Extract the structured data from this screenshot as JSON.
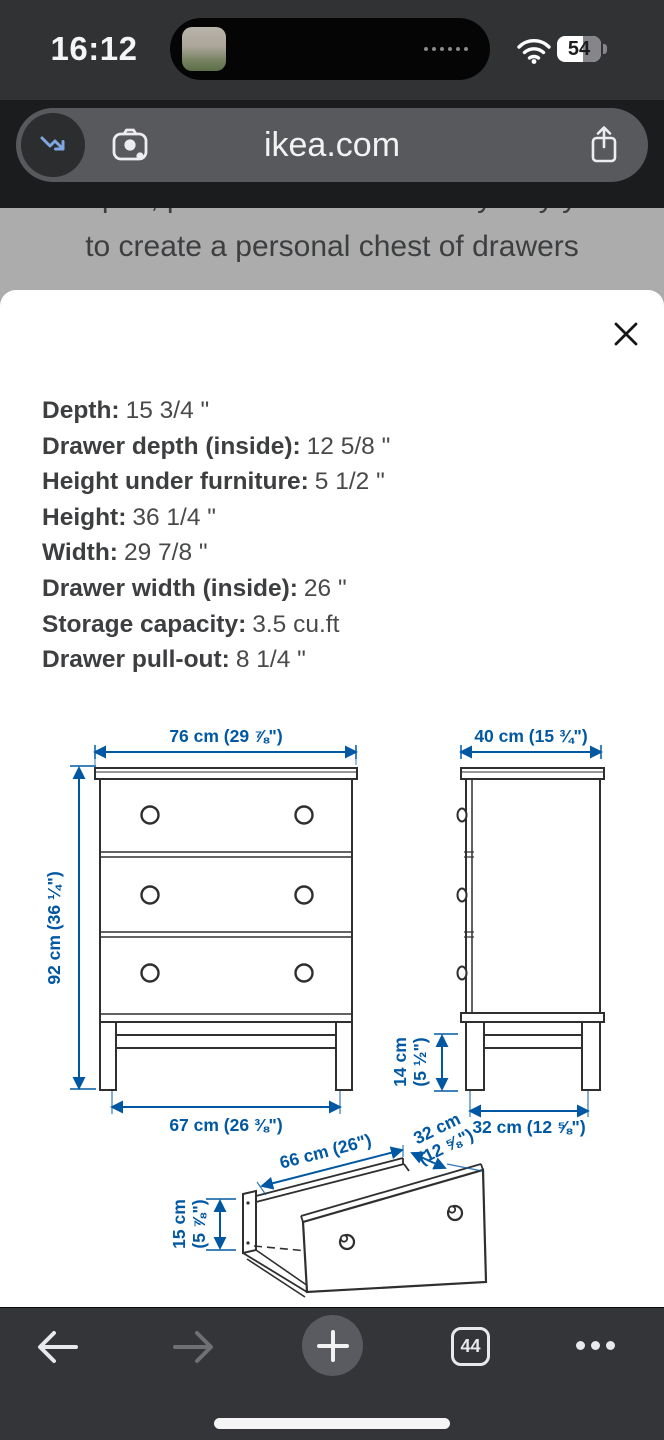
{
  "status_bar": {
    "time": "16:12",
    "battery_percent": "54"
  },
  "url_bar": {
    "domain": "ikea.com"
  },
  "dimmed_page": {
    "partial_line": "shapes, prints and colours in any way you",
    "caption": "to create a personal chest of drawers"
  },
  "modal": {
    "specs": [
      {
        "label": "Depth:",
        "value": "15 3/4 \""
      },
      {
        "label": "Drawer depth (inside):",
        "value": "12 5/8 \""
      },
      {
        "label": "Height under furniture:",
        "value": "5 1/2 \""
      },
      {
        "label": "Height:",
        "value": "36 1/4 \""
      },
      {
        "label": "Width:",
        "value": "29 7/8 \""
      },
      {
        "label": "Drawer width (inside):",
        "value": "26 \""
      },
      {
        "label": "Storage capacity:",
        "value": "3.5 cu.ft"
      },
      {
        "label": "Drawer pull-out:",
        "value": "8 1/4 \""
      }
    ]
  },
  "diagram": {
    "accent_color": "#0058A3",
    "front_width": "76 cm (29 ⅞\")",
    "side_depth": "40 cm (15 ¾\")",
    "total_height": "92 cm (36 ¼\")",
    "leg_span_front": "67 cm (26 ⅜\")",
    "leg_height_cm": "14 cm",
    "leg_height_in": "(5 ½\")",
    "leg_span_side": "32 cm (12 ⅝\")",
    "drawer_width": "66 cm (26\")",
    "drawer_depth_cm": "32 cm",
    "drawer_depth_in": "(12 ⅝\")",
    "drawer_height_cm": "15 cm",
    "drawer_height_in": "(5 ⅞\")"
  },
  "toolbar": {
    "tab_count": "44"
  }
}
